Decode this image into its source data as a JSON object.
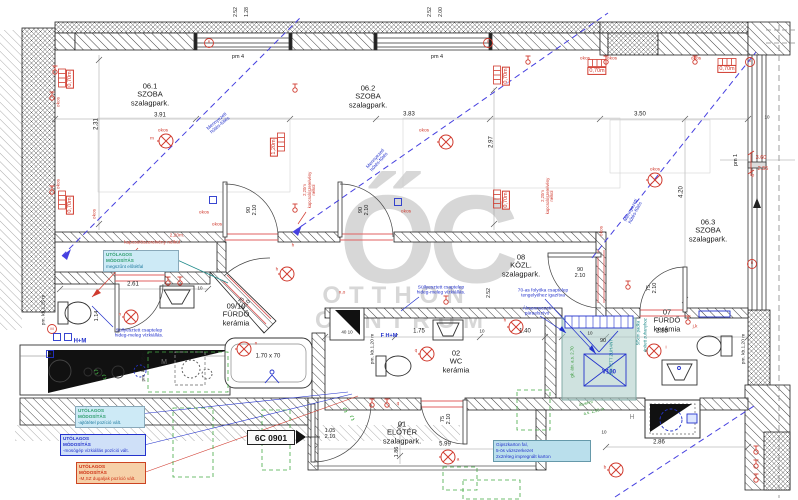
{
  "sheet": {
    "code": "6C 0901"
  },
  "watermark": {
    "monogram": "ŐC",
    "word1": "OTTHON",
    "word2": "CENTRUM"
  },
  "colors": {
    "red": "#d03a2e",
    "blue": "#2433cc",
    "green": "#3a9a3a",
    "teal": "#1f8a8a",
    "dim": "#1a1a1a",
    "watermark": "#bdbdbd",
    "wall": "#222222",
    "note_cyan_bg": "#cdeaf6",
    "note_blue_bg": "#cfe0f8",
    "note_orange_bg": "#f6d0a8",
    "shower_fill": "#a8cac4"
  },
  "rooms": [
    {
      "number": "06.1",
      "name": "SZOBA",
      "finish": "szalagpark.",
      "x": 150,
      "y": 95
    },
    {
      "number": "06.2",
      "name": "SZOBA",
      "finish": "szalagpark.",
      "x": 368,
      "y": 97
    },
    {
      "number": "06.3",
      "name": "SZOBA",
      "finish": "szalagpark.",
      "x": 708,
      "y": 231
    },
    {
      "number": "08",
      "name": "KÖZL.",
      "finish": "szalagpark.",
      "x": 521,
      "y": 266
    },
    {
      "number": "09/10",
      "name": "FÜRDŐ",
      "finish": "kerámia",
      "x": 236,
      "y": 315
    },
    {
      "number": "02",
      "name": "WC",
      "finish": "kerámia",
      "x": 456,
      "y": 362
    },
    {
      "number": "07",
      "name": "FÜRDŐ",
      "finish": "kerámia",
      "x": 667,
      "y": 321
    },
    {
      "number": "01",
      "name": "ELŐTÉR",
      "finish": "szalagpark.",
      "x": 402,
      "y": 433
    }
  ],
  "notes": [
    {
      "title": "UTÓLAGOS\nMÓDOSÍTÁS",
      "note": "megszűnt előtétfal",
      "variant": "cyan",
      "x": 103,
      "y": 250,
      "w": 70
    },
    {
      "title": "UTÓLAGOS\nMÓDOSÍTÁS",
      "note": "-ajtótétel pozíció vált.",
      "variant": "cyan",
      "x": 75,
      "y": 406,
      "w": 64
    },
    {
      "title": "UTÓLAGOS\nMÓDOSÍTÁS",
      "note": "-mosógép vízkiállás pozíció vált.",
      "variant": "blue",
      "x": 60,
      "y": 434,
      "w": 80
    },
    {
      "title": "UTÓLAGOS\nMÓDOSÍTÁS",
      "note": "-M,SZ dugaljak pozíció vált.",
      "variant": "orange",
      "x": 76,
      "y": 462,
      "w": 64
    },
    {
      "title": "",
      "note": "Gipszkarton fal,\n5-ös vázszerkezet\n2x2réteg impregnált karton",
      "variant": "info",
      "x": 493,
      "y": 440,
      "w": 92
    }
  ],
  "labels": [
    {
      "t": "2.31",
      "x": 97,
      "y": 124,
      "r": -90,
      "s": 6
    },
    {
      "t": "3.91",
      "x": 160,
      "y": 116,
      "s": 6
    },
    {
      "t": "3.83",
      "x": 409,
      "y": 115,
      "s": 6
    },
    {
      "t": "2.97",
      "x": 492,
      "y": 142,
      "r": -90,
      "s": 6
    },
    {
      "t": "3.50",
      "x": 640,
      "y": 115,
      "s": 6
    },
    {
      "t": "4.20",
      "x": 682,
      "y": 192,
      "r": -90,
      "s": 6
    },
    {
      "t": "2.61",
      "x": 133,
      "y": 285,
      "s": 6
    },
    {
      "t": "1.14",
      "x": 97,
      "y": 316,
      "r": -90,
      "s": 5.5
    },
    {
      "t": "1.75",
      "x": 419,
      "y": 332,
      "s": 6
    },
    {
      "t": "1.40",
      "x": 525,
      "y": 332,
      "s": 6
    },
    {
      "t": "2.85",
      "x": 662,
      "y": 332,
      "s": 6
    },
    {
      "t": "2.86",
      "x": 659,
      "y": 443,
      "s": 6
    },
    {
      "t": "5.99",
      "x": 445,
      "y": 445,
      "s": 6
    },
    {
      "t": "1.86",
      "x": 397,
      "y": 452,
      "r": -90,
      "s": 5.5
    },
    {
      "t": "2.52",
      "x": 237,
      "y": 12,
      "r": -90,
      "s": 5
    },
    {
      "t": "1.28",
      "x": 248,
      "y": 12,
      "r": -90,
      "s": 5
    },
    {
      "t": "2.52",
      "x": 431,
      "y": 12,
      "r": -90,
      "s": 5
    },
    {
      "t": "2.00",
      "x": 442,
      "y": 12,
      "r": -90,
      "s": 5
    },
    {
      "t": "2.52",
      "x": 490,
      "y": 293,
      "r": -90,
      "s": 5
    },
    {
      "t": "pm 4",
      "x": 238,
      "y": 57,
      "s": 5.5
    },
    {
      "t": "pm 4",
      "x": 437,
      "y": 57,
      "s": 5.5
    },
    {
      "t": "pm 1",
      "x": 736,
      "y": 160,
      "r": -90,
      "s": 5.5
    },
    {
      "t": "90\n2.10",
      "x": 252,
      "y": 210,
      "r": -90,
      "s": 5.5
    },
    {
      "t": "90\n2.10",
      "x": 364,
      "y": 210,
      "r": -90,
      "s": 5.5
    },
    {
      "t": "90\n2.10",
      "x": 580,
      "y": 273,
      "s": 5.5
    },
    {
      "t": "75\n2.10",
      "x": 652,
      "y": 288,
      "r": -90,
      "s": 5.5
    },
    {
      "t": "75\n2.10",
      "x": 244,
      "y": 303,
      "r": -48,
      "s": 5.5
    },
    {
      "t": "75\n2.10",
      "x": 446,
      "y": 419,
      "r": -90,
      "s": 5.5
    },
    {
      "t": "1.05\n2.10",
      "x": 330,
      "y": 434,
      "s": 5.5
    },
    {
      "t": "90",
      "x": 603,
      "y": 341,
      "s": 5.5
    },
    {
      "t": "1.70 x 70",
      "x": 268,
      "y": 357,
      "s": 6
    },
    {
      "t": "10",
      "x": 200,
      "y": 288,
      "s": 4.5
    },
    {
      "t": "10",
      "x": 482,
      "y": 331,
      "s": 4.5
    },
    {
      "t": "10",
      "x": 590,
      "y": 333,
      "s": 4.5
    },
    {
      "t": "10",
      "x": 604,
      "y": 432,
      "s": 4.5
    },
    {
      "t": "10",
      "x": 767,
      "y": 117,
      "s": 4.5
    },
    {
      "t": "40 10",
      "x": 347,
      "y": 332,
      "s": 4.5
    },
    {
      "t": "M",
      "x": 164,
      "y": 363,
      "c": "#777777",
      "s": 7
    },
    {
      "t": "H",
      "x": 632,
      "y": 418,
      "c": "#8a8a8a",
      "s": 7
    },
    {
      "t": "pm. kb.1,25 m",
      "x": 44,
      "y": 310,
      "r": -90,
      "s": 4.8
    },
    {
      "t": "pm. kb.0,95m",
      "x": 144,
      "y": 367,
      "r": -90,
      "s": 4.8
    },
    {
      "t": "pm. kb.1,20 m",
      "x": 373,
      "y": 349,
      "r": -90,
      "s": 4.8
    },
    {
      "t": "pm. kb.1,20 m",
      "x": 744,
      "y": 349,
      "r": -90,
      "s": 4.8
    },
    {
      "t": "0,70m",
      "x": 70,
      "y": 79,
      "r": -90,
      "c": "#d03a2e",
      "s": 5.5,
      "b": 1
    },
    {
      "t": "0,70m",
      "x": 70,
      "y": 205,
      "r": -90,
      "c": "#d03a2e",
      "s": 5.5,
      "b": 1
    },
    {
      "t": "0,70m",
      "x": 506,
      "y": 76,
      "r": -90,
      "c": "#d03a2e",
      "s": 5.5,
      "b": 1
    },
    {
      "t": "0,70m",
      "x": 506,
      "y": 200,
      "r": -90,
      "c": "#d03a2e",
      "s": 5.5,
      "b": 1
    },
    {
      "t": "0,70m",
      "x": 597,
      "y": 71,
      "c": "#d03a2e",
      "s": 5.5,
      "b": 1
    },
    {
      "t": "0,70m",
      "x": 727,
      "y": 69,
      "c": "#d03a2e",
      "s": 5.5,
      "b": 1
    },
    {
      "t": "1,20m",
      "x": 274,
      "y": 147,
      "r": -90,
      "c": "#d03a2e",
      "s": 5.5,
      "b": 1
    },
    {
      "t": "okos",
      "x": 59,
      "y": 102,
      "r": -90,
      "c": "#d03a2e",
      "s": 4.8
    },
    {
      "t": "okos",
      "x": 59,
      "y": 184,
      "r": -90,
      "c": "#d03a2e",
      "s": 4.8
    },
    {
      "t": "okos",
      "x": 95,
      "y": 214,
      "r": -90,
      "c": "#d03a2e",
      "s": 4.8
    },
    {
      "t": "okos",
      "x": 163,
      "y": 131,
      "c": "#d03a2e",
      "s": 4.8
    },
    {
      "t": "okos",
      "x": 204,
      "y": 213,
      "c": "#d03a2e",
      "s": 4.8
    },
    {
      "t": "okos",
      "x": 217,
      "y": 225,
      "c": "#d03a2e",
      "s": 4.8
    },
    {
      "t": "okos",
      "x": 424,
      "y": 131,
      "c": "#d03a2e",
      "s": 4.8
    },
    {
      "t": "okos",
      "x": 406,
      "y": 212,
      "c": "#d03a2e",
      "s": 4.8
    },
    {
      "t": "okos",
      "x": 585,
      "y": 59,
      "c": "#d03a2e",
      "s": 4.8
    },
    {
      "t": "okos",
      "x": 612,
      "y": 59,
      "c": "#d03a2e",
      "s": 4.8
    },
    {
      "t": "okos",
      "x": 696,
      "y": 59,
      "c": "#d03a2e",
      "s": 4.8
    },
    {
      "t": "okos",
      "x": 602,
      "y": 231,
      "r": -90,
      "c": "#d03a2e",
      "s": 4.8
    },
    {
      "t": "okos",
      "x": 655,
      "y": 170,
      "c": "#d03a2e",
      "s": 4.8
    },
    {
      "t": "m",
      "x": 152,
      "y": 139,
      "c": "#d03a2e",
      "s": 4.8
    },
    {
      "t": "h",
      "x": 293,
      "y": 246,
      "c": "#d03a2e",
      "s": 4.8
    },
    {
      "t": "h",
      "x": 277,
      "y": 270,
      "c": "#d03a2e",
      "s": 4.8
    },
    {
      "t": "h",
      "x": 505,
      "y": 321,
      "c": "#d03a2e",
      "s": 4.8
    },
    {
      "t": "q",
      "x": 416,
      "y": 351,
      "c": "#d03a2e",
      "s": 4.8
    },
    {
      "t": "i",
      "x": 666,
      "y": 348,
      "c": "#d03a2e",
      "s": 4.8
    },
    {
      "t": "a",
      "x": 458,
      "y": 460,
      "c": "#d03a2e",
      "s": 4.8
    },
    {
      "t": "b",
      "x": 605,
      "y": 468,
      "c": "#d03a2e",
      "s": 4.8
    },
    {
      "t": "n",
      "x": 120,
      "y": 315,
      "c": "#d03a2e",
      "s": 4.8
    },
    {
      "t": "n",
      "x": 256,
      "y": 344,
      "c": "#d03a2e",
      "s": 4.8
    },
    {
      "t": "n,o",
      "x": 342,
      "y": 293,
      "c": "#d03a2e",
      "s": 4.8
    },
    {
      "t": "j,k",
      "x": 695,
      "y": 327,
      "c": "#d03a2e",
      "s": 4.8
    },
    {
      "t": "p",
      "x": 753,
      "y": 176,
      "c": "#d03a2e",
      "s": 4.8
    },
    {
      "t": "q",
      "x": 398,
      "y": 404,
      "c": "#d03a2e",
      "s": 4.8
    },
    {
      "t": "M",
      "x": 52,
      "y": 329,
      "c": "#d03a2e",
      "s": 4
    },
    {
      "t": "R",
      "x": 209,
      "y": 43,
      "c": "#d03a2e",
      "s": 3.5
    },
    {
      "t": "R",
      "x": 488,
      "y": 43,
      "c": "#d03a2e",
      "s": 3.5
    },
    {
      "t": "a",
      "x": 750,
      "y": 62,
      "c": "#d03a2e",
      "s": 3.5
    },
    {
      "t": "R",
      "x": 752,
      "y": 264,
      "c": "#d03a2e",
      "s": 3.5
    },
    {
      "t": "3.60",
      "x": 761,
      "y": 158,
      "c": "#d03a2e",
      "s": 5.5
    },
    {
      "t": "2.55",
      "x": 763,
      "y": 169,
      "c": "#d03a2e",
      "s": 5.5
    },
    {
      "t": "2,20m.",
      "x": 177,
      "y": 236,
      "c": "#d03a2e",
      "s": 4.8
    },
    {
      "t": "kapcsolószerelvény nélkül",
      "x": 152,
      "y": 243,
      "c": "#d03a2e",
      "s": 4.8
    },
    {
      "t": "2,20m\nkapcsolószerelvény\nnélkül",
      "x": 310,
      "y": 190,
      "r": -90,
      "c": "#d03a2e",
      "s": 4.2
    },
    {
      "t": "2,20m\nkapcsolószerelvény\nnélkül",
      "x": 548,
      "y": 196,
      "r": -90,
      "c": "#d03a2e",
      "s": 4.2
    },
    {
      "t": "Süllyesztett csaptelep\nhideg-meleg vízkiállás.",
      "x": 139,
      "y": 334,
      "c": "#2433cc",
      "s": 4.8
    },
    {
      "t": "Süllyesztett csaptelep\nhideg-meleg vízkiállás.",
      "x": 441,
      "y": 291,
      "c": "#2433cc",
      "s": 4.8
    },
    {
      "t": "70-as folyóka csaptelep\ntengelyéhez igazítva",
      "x": 543,
      "y": 294,
      "c": "#2433cc",
      "s": 4.8
    },
    {
      "t": "Álmennyezeti\npáraelszívó",
      "x": 537,
      "y": 312,
      "c": "#2433cc",
      "s": 4.8
    },
    {
      "t": "V100",
      "x": 609,
      "y": 373,
      "c": "#2433cc",
      "s": 6,
      "f": 1
    },
    {
      "t": "H+M",
      "x": 80,
      "y": 342,
      "c": "#2433cc",
      "s": 6,
      "f": 1
    },
    {
      "t": "F H+M",
      "x": 389,
      "y": 336,
      "c": "#2433cc",
      "s": 5.5,
      "f": 1
    },
    {
      "t": "H",
      "x": 50,
      "y": 354,
      "c": "#2433cc",
      "s": 4
    },
    {
      "t": "Mennyezeti\nhűtés-fűtés",
      "x": 219,
      "y": 124,
      "r": -40,
      "c": "#2433cc",
      "s": 4.8
    },
    {
      "t": "Mennyezeti\nhűtés-fűtés",
      "x": 378,
      "y": 161,
      "r": -48,
      "c": "#2433cc",
      "s": 4.8
    },
    {
      "t": "Mennyezeti\nhűtés-fűtés",
      "x": 634,
      "y": 212,
      "r": -62,
      "c": "#2433cc",
      "s": 4.8
    },
    {
      "t": "ÉPÍTETT ZUHANY",
      "x": 612,
      "y": 357,
      "r": -90,
      "c": "#1f8a8a",
      "s": 4.3
    },
    {
      "t": "5/5cm padka",
      "x": 639,
      "y": 333,
      "r": -90,
      "c": "#1f8a8a",
      "s": 4.3
    },
    {
      "t": "épített zuhanyhoz",
      "x": 646,
      "y": 335,
      "r": -90,
      "c": "#1f8a8a",
      "s": 4.3
    },
    {
      "t": "átvenni",
      "x": 586,
      "y": 404,
      "r": -14,
      "c": "#3a9a3a",
      "s": 4.3
    },
    {
      "t": "a.s. 2,50 m",
      "x": 594,
      "y": 412,
      "r": -14,
      "c": "#3a9a3a",
      "s": 4.3
    },
    {
      "t": "gk. átv. a.s. 2,70",
      "x": 573,
      "y": 362,
      "r": -90,
      "c": "#3a9a3a",
      "s": 4.3
    }
  ]
}
